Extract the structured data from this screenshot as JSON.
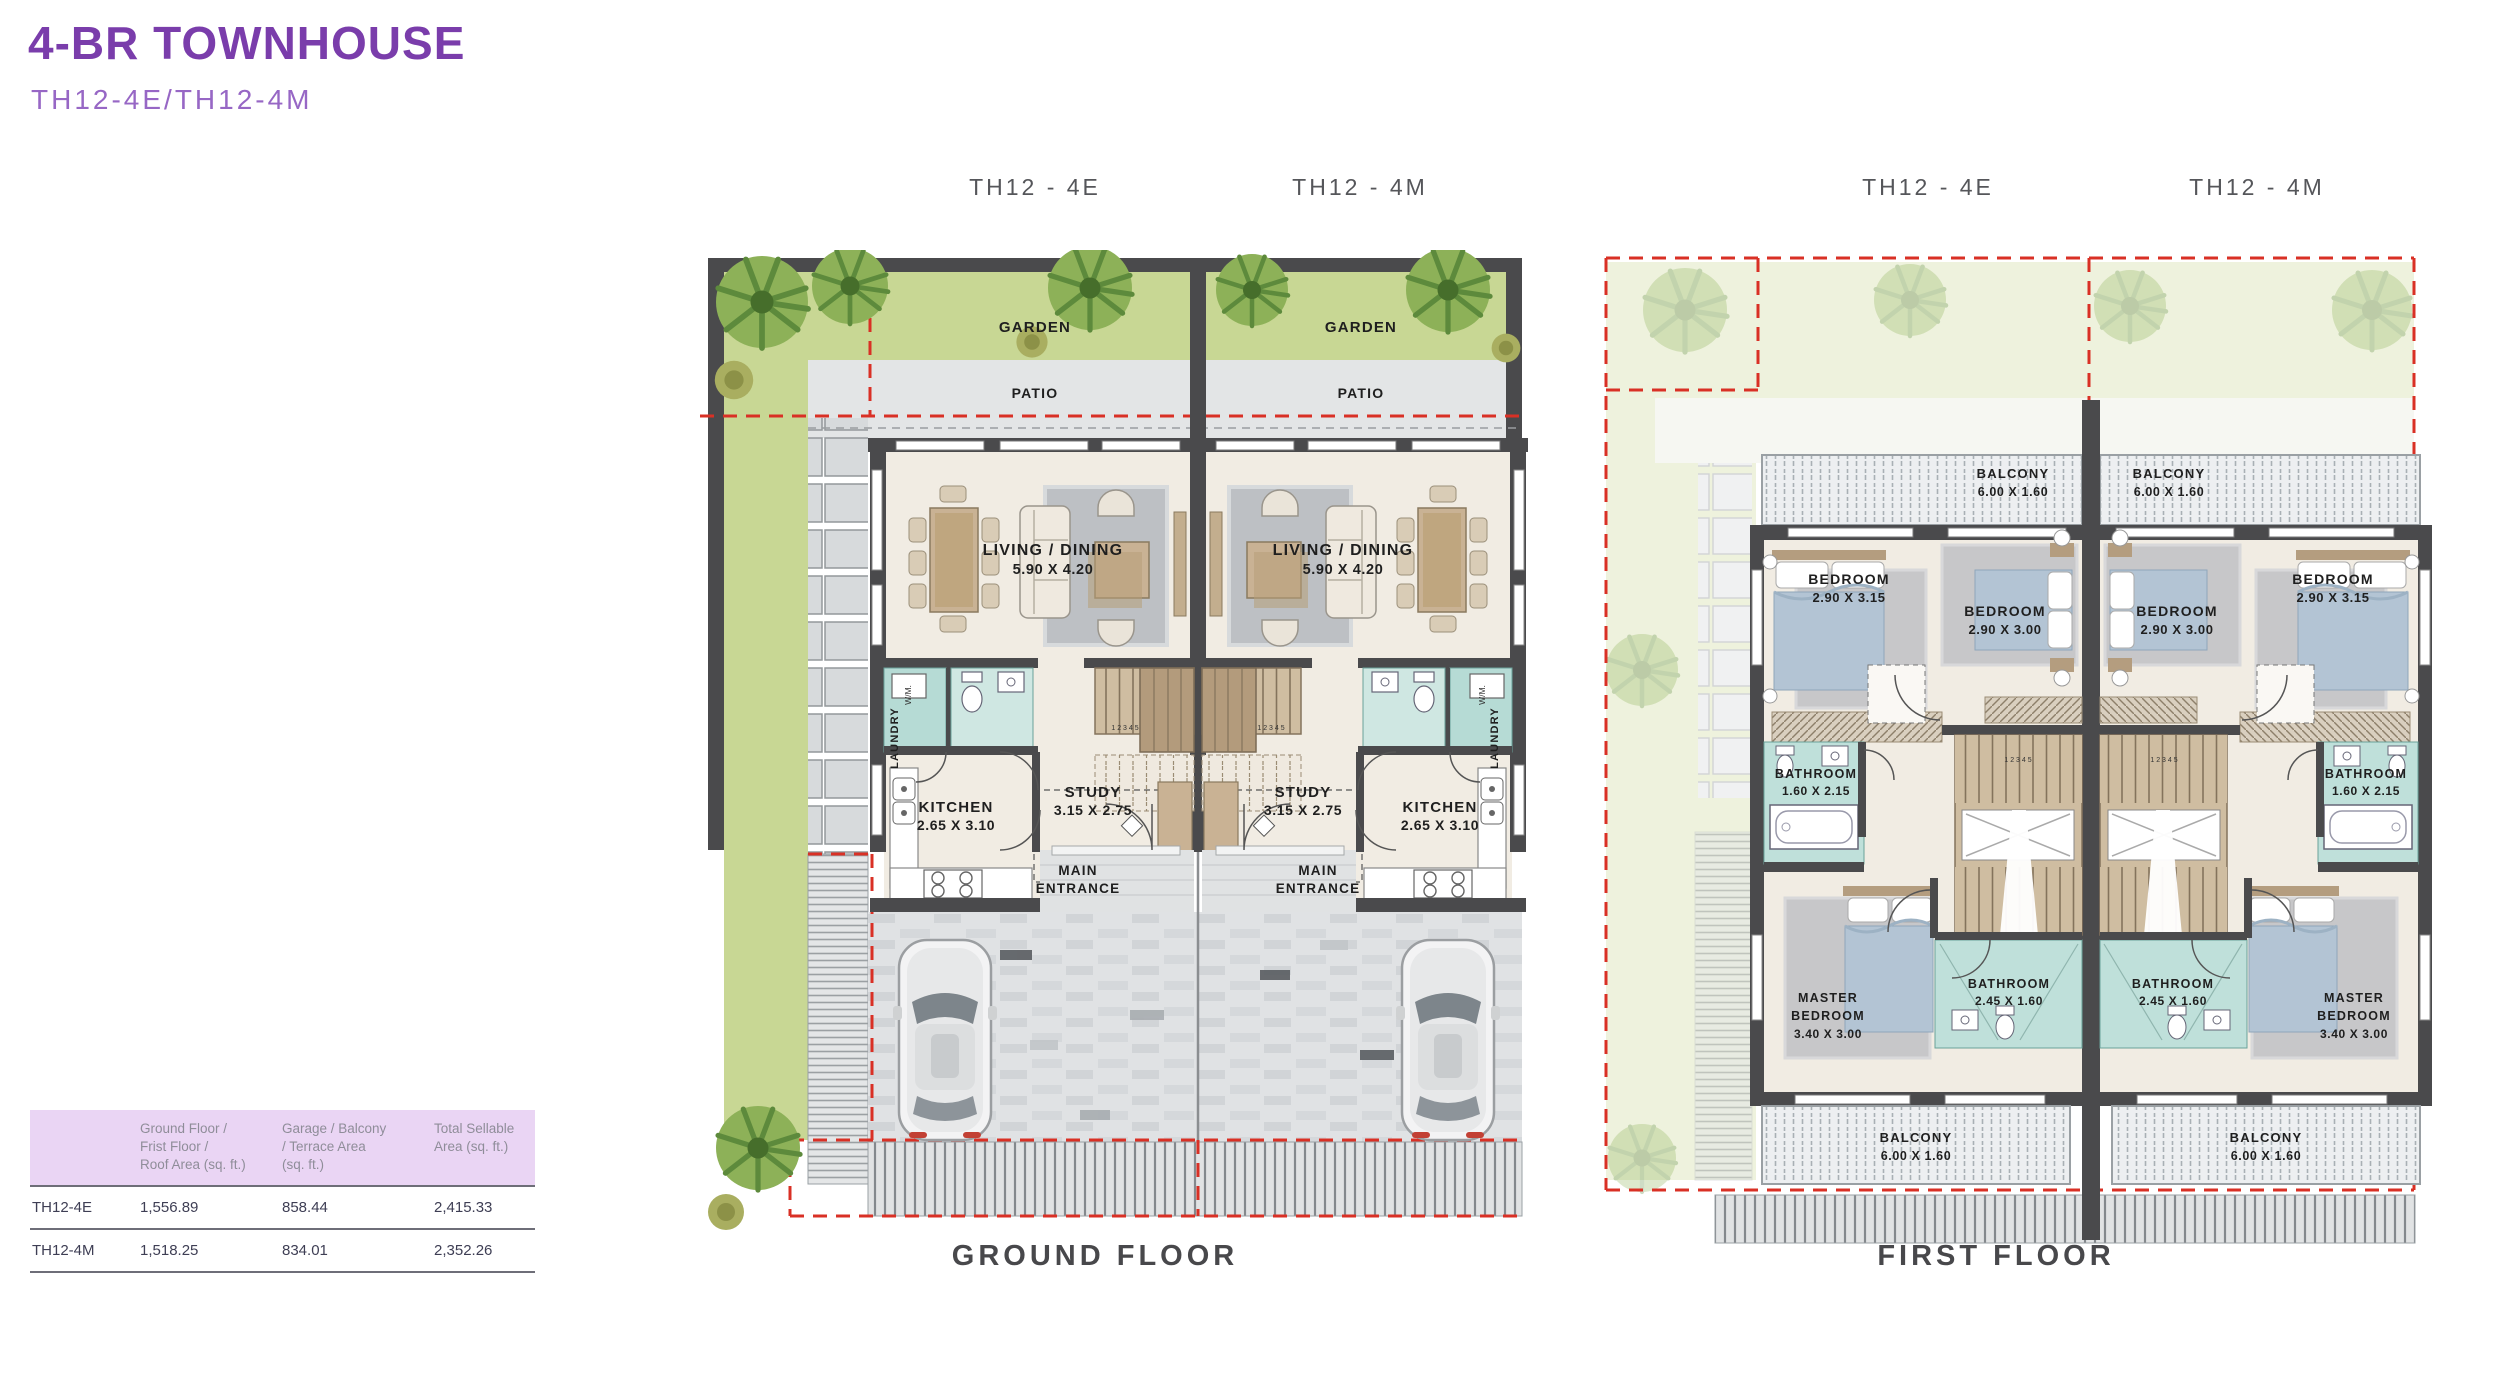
{
  "page": {
    "title": "4-BR TOWNHOUSE",
    "subtitle": "TH12-4E/TH12-4M"
  },
  "units": {
    "left": "TH12 - 4E",
    "right": "TH12 - 4M"
  },
  "floors": {
    "ground_caption": "GROUND FLOOR",
    "first_caption": "FIRST FLOOR"
  },
  "ground_rooms": {
    "garden": "GARDEN",
    "patio": "PATIO",
    "living": {
      "name": "LIVING / DINING",
      "dims": "5.90 X 4.20"
    },
    "study": {
      "name": "STUDY",
      "dims": "3.15 X 2.75"
    },
    "kitchen": {
      "name": "KITCHEN",
      "dims": "2.65 X 3.10"
    },
    "laundry": "LAUNDRY",
    "washer": "W/M.",
    "entrance": {
      "line1": "MAIN",
      "line2": "ENTRANCE"
    }
  },
  "first_rooms": {
    "balcony": {
      "name": "BALCONY",
      "dims": "6.00 X 1.60"
    },
    "bedroom_corner": {
      "name": "BEDROOM",
      "dims": "2.90 X 3.15"
    },
    "bedroom_middle": {
      "name": "BEDROOM",
      "dims": "2.90 X 3.00"
    },
    "bathroom_ensuite": {
      "name": "BATHROOM",
      "dims": "1.60 X 2.15"
    },
    "bathroom_shared": {
      "name": "BATHROOM",
      "dims": "2.45 X 1.60"
    },
    "master": {
      "line1": "MASTER",
      "line2": "BEDROOM",
      "dims": "3.40 X 3.00"
    }
  },
  "stair_numbers": "1 2 3 4 5",
  "area_table": {
    "columns": [
      {
        "lines": [
          "Ground Floor /",
          "Frist Floor /",
          "Roof Area (sq. ft.)"
        ]
      },
      {
        "lines": [
          "Garage / Balcony",
          "/ Terrace Area",
          "(sq. ft.)"
        ]
      },
      {
        "lines": [
          "Total Sellable",
          "Area (sq. ft.)"
        ]
      }
    ],
    "rows": [
      {
        "unit": "TH12-4E",
        "floor_area": "1,556.89",
        "garage_area": "858.44",
        "total": "2,415.33"
      },
      {
        "unit": "TH12-4M",
        "floor_area": "1,518.25",
        "garage_area": "834.01",
        "total": "2,352.26"
      }
    ]
  },
  "colors": {
    "accent_purple": "#7A3DAB",
    "subtitle_purple": "#9767C5",
    "table_header_bg": "#EAD5F4",
    "table_header_text": "#8F8D99",
    "table_text": "#3E3E54",
    "boundary_red": "#D93025",
    "wall_dark": "#4A4A4C",
    "garden_green": "#C8D794",
    "tile_teal": "#B6DBD5",
    "floor_cream": "#F1ECE3"
  }
}
